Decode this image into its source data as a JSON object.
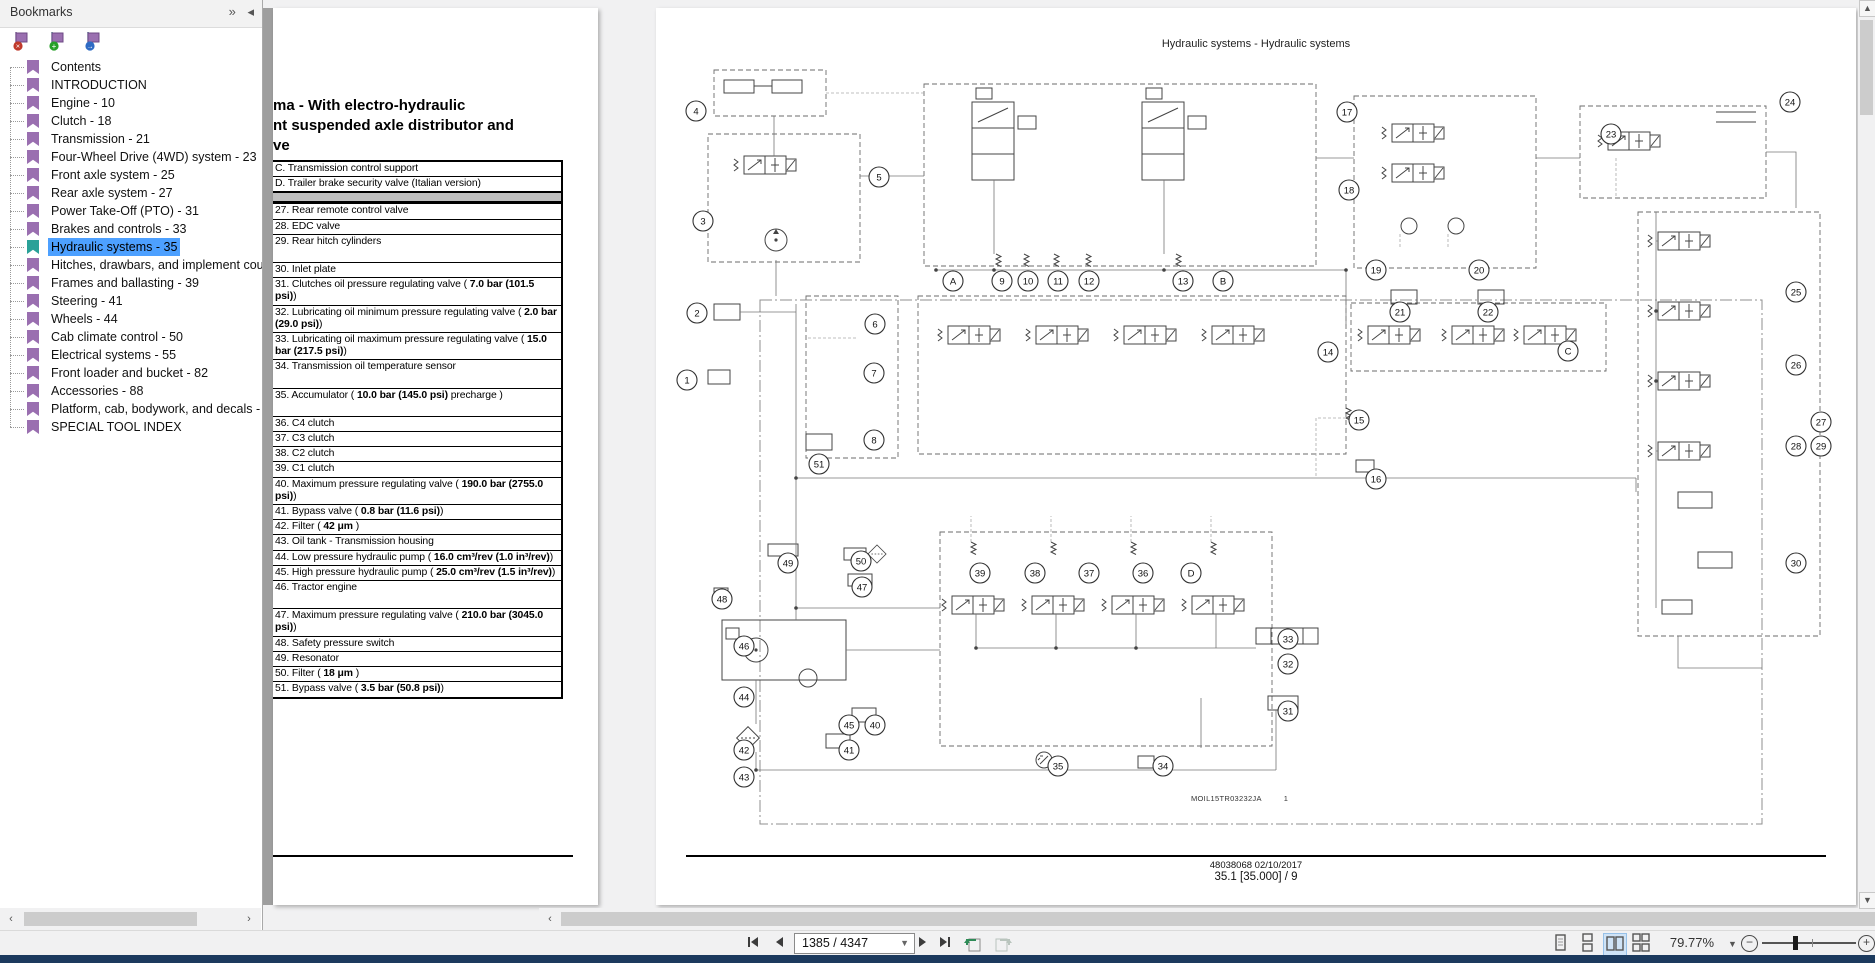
{
  "bookmarks_panel": {
    "title": "Bookmarks",
    "header_buttons": [
      {
        "name": "dock-panel-icon",
        "glyph": "»"
      },
      {
        "name": "collapse-panel-icon",
        "glyph": "◂"
      }
    ],
    "tool_icons": [
      {
        "name": "delete-bookmark-icon",
        "badge": "×",
        "badge_color": "#c0392b"
      },
      {
        "name": "add-bookmark-icon",
        "badge": "+",
        "badge_color": "#27a027"
      },
      {
        "name": "goto-bookmark-icon",
        "badge": "→",
        "badge_color": "#2e6bc4"
      }
    ],
    "items": [
      {
        "label": "Contents",
        "selected": false
      },
      {
        "label": "INTRODUCTION",
        "selected": false
      },
      {
        "label": "Engine - 10",
        "selected": false
      },
      {
        "label": "Clutch - 18",
        "selected": false
      },
      {
        "label": "Transmission - 21",
        "selected": false
      },
      {
        "label": "Four-Wheel Drive (4WD) system - 23",
        "selected": false
      },
      {
        "label": "Front axle system - 25",
        "selected": false
      },
      {
        "label": "Rear axle system - 27",
        "selected": false
      },
      {
        "label": "Power Take-Off (PTO) - 31",
        "selected": false
      },
      {
        "label": "Brakes and controls - 33",
        "selected": false
      },
      {
        "label": "Hydraulic systems - 35",
        "selected": true
      },
      {
        "label": "Hitches, drawbars, and implement cou",
        "selected": false
      },
      {
        "label": "Frames and ballasting - 39",
        "selected": false
      },
      {
        "label": "Steering - 41",
        "selected": false
      },
      {
        "label": "Wheels - 44",
        "selected": false
      },
      {
        "label": "Cab climate control - 50",
        "selected": false
      },
      {
        "label": "Electrical systems - 55",
        "selected": false
      },
      {
        "label": "Front loader and bucket - 82",
        "selected": false
      },
      {
        "label": "Accessories - 88",
        "selected": false
      },
      {
        "label": "Platform, cab, bodywork, and decals -",
        "selected": false
      },
      {
        "label": "SPECIAL TOOL INDEX",
        "selected": false
      }
    ]
  },
  "left_page": {
    "title_lines": [
      "ma - With electro-hydraulic",
      "nt suspended axle distributor and",
      "ve"
    ],
    "legend_rows": [
      {
        "id": "C",
        "parts": [
          {
            "t": "C. Transmission control support"
          }
        ]
      },
      {
        "id": "D",
        "parts": [
          {
            "t": "D. Trailer brake security valve (Italian version)"
          }
        ]
      },
      {
        "band": true
      },
      {
        "id": "27",
        "parts": [
          {
            "t": "27. Rear remote control valve"
          }
        ]
      },
      {
        "id": "28",
        "parts": [
          {
            "t": "28. EDC valve"
          }
        ]
      },
      {
        "id": "29",
        "tall": true,
        "parts": [
          {
            "t": "29. Rear hitch cylinders"
          }
        ]
      },
      {
        "id": "30",
        "parts": [
          {
            "t": "30. Inlet plate"
          }
        ]
      },
      {
        "id": "31",
        "parts": [
          {
            "t": "31. Clutches oil pressure regulating valve ( "
          },
          {
            "t": "7.0 bar (101.5 psi)",
            "b": true
          },
          {
            "t": ")"
          }
        ]
      },
      {
        "id": "32",
        "parts": [
          {
            "t": "32. Lubricating oil minimum pressure regulating valve ( "
          },
          {
            "t": "2.0 bar (29.0 psi)",
            "b": true
          },
          {
            "t": ")"
          }
        ]
      },
      {
        "id": "33",
        "parts": [
          {
            "t": "33. Lubricating oil maximum pressure regulating valve ( "
          },
          {
            "t": "15.0 bar (217.5 psi)",
            "b": true
          },
          {
            "t": ")"
          }
        ]
      },
      {
        "id": "34",
        "tall": true,
        "parts": [
          {
            "t": "34. Transmission oil temperature sensor"
          }
        ]
      },
      {
        "id": "35",
        "tall": true,
        "parts": [
          {
            "t": "35. Accumulator ( "
          },
          {
            "t": "10.0 bar (145.0 psi)",
            "b": true
          },
          {
            "t": " precharge )"
          }
        ]
      },
      {
        "id": "36",
        "parts": [
          {
            "t": "36. C4 clutch"
          }
        ]
      },
      {
        "id": "37",
        "parts": [
          {
            "t": "37. C3 clutch"
          }
        ]
      },
      {
        "id": "38",
        "parts": [
          {
            "t": "38. C2 clutch"
          }
        ]
      },
      {
        "id": "39",
        "parts": [
          {
            "t": "39. C1 clutch"
          }
        ]
      },
      {
        "id": "40",
        "parts": [
          {
            "t": "40. Maximum pressure regulating valve ( "
          },
          {
            "t": "190.0 bar (2755.0 psi)",
            "b": true
          },
          {
            "t": ")"
          }
        ]
      },
      {
        "id": "41",
        "parts": [
          {
            "t": "41. Bypass valve ( "
          },
          {
            "t": "0.8 bar (11.6 psi)",
            "b": true
          },
          {
            "t": ")"
          }
        ]
      },
      {
        "id": "42",
        "parts": [
          {
            "t": "42. Filter ( "
          },
          {
            "t": "42 μm",
            "b": true
          },
          {
            "t": " )"
          }
        ]
      },
      {
        "id": "43",
        "parts": [
          {
            "t": "43. Oil tank - Transmission housing"
          }
        ]
      },
      {
        "id": "44",
        "parts": [
          {
            "t": "44. Low pressure hydraulic pump ( "
          },
          {
            "t": "16.0 cm³/rev (1.0 in³/rev)",
            "b": true
          },
          {
            "t": ")"
          }
        ]
      },
      {
        "id": "45",
        "parts": [
          {
            "t": "45. High pressure hydraulic pump ( "
          },
          {
            "t": "25.0 cm³/rev (1.5 in³/rev)",
            "b": true
          },
          {
            "t": ")"
          }
        ]
      },
      {
        "id": "46",
        "tall": true,
        "parts": [
          {
            "t": "46. Tractor engine"
          }
        ]
      },
      {
        "id": "47",
        "parts": [
          {
            "t": "47. Maximum pressure regulating valve ( "
          },
          {
            "t": "210.0 bar (3045.0 psi)",
            "b": true
          },
          {
            "t": ")"
          }
        ]
      },
      {
        "id": "48",
        "parts": [
          {
            "t": "48. Safety pressure switch"
          }
        ]
      },
      {
        "id": "49",
        "parts": [
          {
            "t": "49. Resonator"
          }
        ]
      },
      {
        "id": "50",
        "parts": [
          {
            "t": "50. Filter ( "
          },
          {
            "t": "18 μm",
            "b": true
          },
          {
            "t": " )"
          }
        ]
      },
      {
        "id": "51",
        "parts": [
          {
            "t": "51. Bypass valve ( "
          },
          {
            "t": "3.5 bar (50.8 psi)",
            "b": true
          },
          {
            "t": ")"
          }
        ]
      }
    ]
  },
  "right_page": {
    "header": "Hydraulic systems - Hydraulic systems",
    "diagram_ref": "MOIL15TR03232JA",
    "diagram_sheet": "1",
    "footer_line1": "48038068 02/10/2017",
    "footer_line2": "35.1 [35.000] / 9",
    "callouts": [
      {
        "label": "4",
        "x": 40,
        "y": 103
      },
      {
        "label": "5",
        "x": 223,
        "y": 169
      },
      {
        "label": "3",
        "x": 47,
        "y": 213
      },
      {
        "label": "17",
        "x": 691,
        "y": 104
      },
      {
        "label": "24",
        "x": 1134,
        "y": 94
      },
      {
        "label": "23",
        "x": 955,
        "y": 126
      },
      {
        "label": "18",
        "x": 693,
        "y": 182
      },
      {
        "label": "2",
        "x": 41,
        "y": 305
      },
      {
        "label": "1",
        "x": 31,
        "y": 372
      },
      {
        "label": "6",
        "x": 219,
        "y": 316
      },
      {
        "label": "7",
        "x": 218,
        "y": 365
      },
      {
        "label": "8",
        "x": 218,
        "y": 432
      },
      {
        "label": "A",
        "x": 297,
        "y": 273
      },
      {
        "label": "9",
        "x": 346,
        "y": 273
      },
      {
        "label": "10",
        "x": 372,
        "y": 273
      },
      {
        "label": "11",
        "x": 402,
        "y": 273
      },
      {
        "label": "12",
        "x": 433,
        "y": 273
      },
      {
        "label": "13",
        "x": 527,
        "y": 273
      },
      {
        "label": "B",
        "x": 567,
        "y": 273
      },
      {
        "label": "19",
        "x": 720,
        "y": 262
      },
      {
        "label": "20",
        "x": 823,
        "y": 262
      },
      {
        "label": "21",
        "x": 744,
        "y": 304
      },
      {
        "label": "22",
        "x": 832,
        "y": 304
      },
      {
        "label": "C",
        "x": 912,
        "y": 343
      },
      {
        "label": "14",
        "x": 672,
        "y": 344
      },
      {
        "label": "15",
        "x": 703,
        "y": 412
      },
      {
        "label": "16",
        "x": 720,
        "y": 471
      },
      {
        "label": "25",
        "x": 1140,
        "y": 284
      },
      {
        "label": "26",
        "x": 1140,
        "y": 357
      },
      {
        "label": "27",
        "x": 1165,
        "y": 414
      },
      {
        "label": "28",
        "x": 1140,
        "y": 438
      },
      {
        "label": "29",
        "x": 1165,
        "y": 438
      },
      {
        "label": "30",
        "x": 1140,
        "y": 555
      },
      {
        "label": "51",
        "x": 163,
        "y": 456
      },
      {
        "label": "49",
        "x": 132,
        "y": 555
      },
      {
        "label": "50",
        "x": 205,
        "y": 553
      },
      {
        "label": "47",
        "x": 206,
        "y": 579
      },
      {
        "label": "48",
        "x": 66,
        "y": 591
      },
      {
        "label": "46",
        "x": 88,
        "y": 638
      },
      {
        "label": "44",
        "x": 88,
        "y": 689
      },
      {
        "label": "45",
        "x": 193,
        "y": 717
      },
      {
        "label": "40",
        "x": 219,
        "y": 717
      },
      {
        "label": "42",
        "x": 88,
        "y": 742
      },
      {
        "label": "41",
        "x": 193,
        "y": 742
      },
      {
        "label": "43",
        "x": 88,
        "y": 769
      },
      {
        "label": "39",
        "x": 324,
        "y": 565
      },
      {
        "label": "38",
        "x": 379,
        "y": 565
      },
      {
        "label": "37",
        "x": 433,
        "y": 565
      },
      {
        "label": "36",
        "x": 487,
        "y": 565
      },
      {
        "label": "D",
        "x": 535,
        "y": 565
      },
      {
        "label": "33",
        "x": 632,
        "y": 631
      },
      {
        "label": "32",
        "x": 632,
        "y": 656
      },
      {
        "label": "31",
        "x": 632,
        "y": 703
      },
      {
        "label": "35",
        "x": 402,
        "y": 758
      },
      {
        "label": "34",
        "x": 507,
        "y": 758
      }
    ]
  },
  "toolbar": {
    "page_field": "1385 / 4347",
    "zoom_value": "79.77%",
    "nav_icons": [
      "first-page",
      "previous-page",
      "next-page",
      "last-page",
      "previous-view",
      "next-view"
    ],
    "layout_icons": [
      "single-page-view",
      "continuous-view",
      "two-page-view",
      "two-page-scroll-view"
    ],
    "zoom_icons": [
      "zoom-out",
      "zoom-slider",
      "zoom-in"
    ]
  },
  "colors": {
    "selection_blue": "#4da0ff",
    "bookmark_purple": "#9a6fb0",
    "bookmark_selected_teal": "#2aa198",
    "status_bar_navy": "#1c3a5e",
    "active_tool_bg": "#cfe3f6",
    "legend_band_gray": "#bfbfbf",
    "page_edge_gray": "#9e9e9e"
  }
}
